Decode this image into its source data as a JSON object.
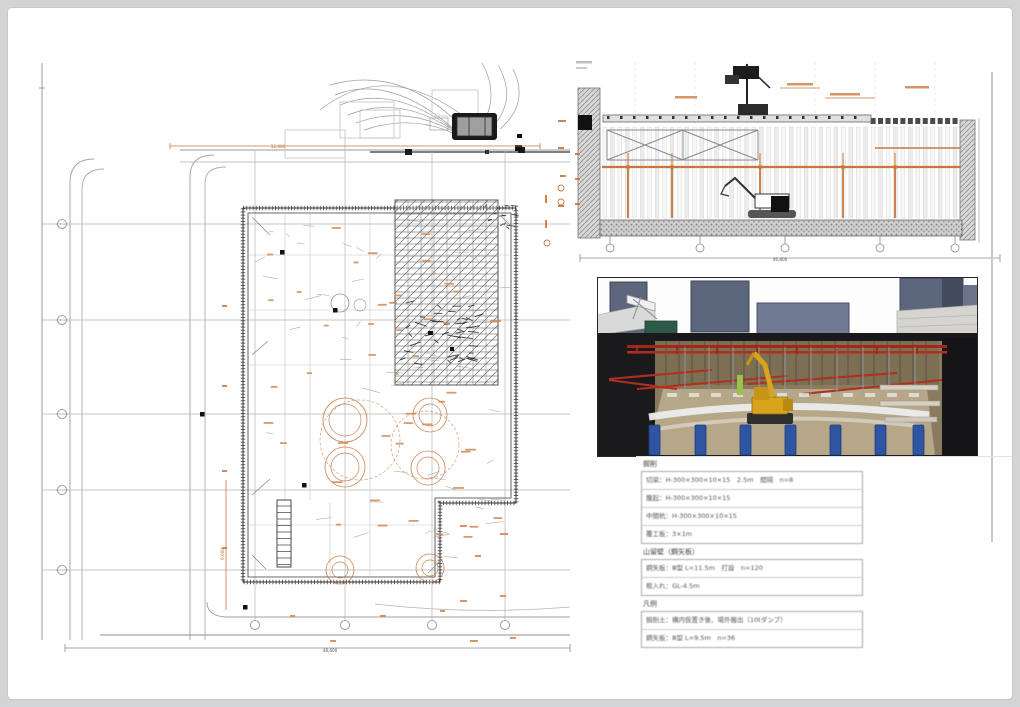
{
  "colors": {
    "orange": "#c9763d",
    "orange_soft": "#d08a55",
    "wall_gray": "#4a4a4a",
    "line_gray": "#9a9a9a",
    "grid_gray": "#b5b5b5",
    "strut_red": "#b03020",
    "strut_red_dark": "#a2261a",
    "pile_blue": "#2e54a2",
    "excavator_yellow": "#d8a41c",
    "building_slate": "#5c667c",
    "earth_brown": "#8a7b5e",
    "floor_tan": "#b5a788"
  },
  "plan": {
    "bottom_dim": "48,600",
    "top_dim": "32,400",
    "left_dim": "9,000"
  },
  "section": {
    "bottom_dim": "46,800"
  },
  "notes": {
    "g1_title": "掘削",
    "g1_rows": [
      "切梁：H-300×300×10×15　2.5m　間隔　n=8",
      "腹起：H-300×300×10×15",
      "中間杭：H-300×300×10×15",
      "覆工板：3×1m"
    ],
    "g2_title": "山留壁（鋼矢板）",
    "g2_rows": [
      "鋼矢板：Ⅲ型 L=11.5m　打設　n=120",
      "根入れ：GL-4.5m"
    ],
    "g3_title": "凡例",
    "g3_rows": [
      "掘削土：構内仮置き後、場外搬出（10tダンプ）",
      "鋼矢板：Ⅲ型 L=9.5m　n=36"
    ]
  }
}
